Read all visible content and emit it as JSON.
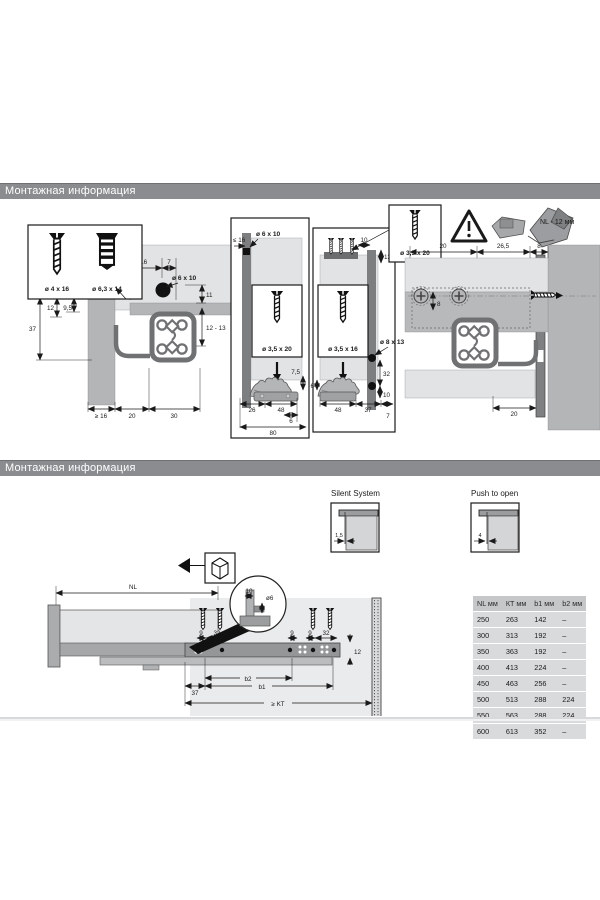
{
  "colors": {
    "header_bar": "#8a8c8f",
    "accent_green": "#2e6b3e",
    "light_gray": "#e2e3e4",
    "mid_gray": "#b3b5b7",
    "profile_gray": "#6f7173"
  },
  "s1": {
    "header": "Монтажная информация",
    "screw_box": {
      "screw1": "ø 4 x 16",
      "screw2": "ø 6,3 x 14"
    },
    "left": {
      "le16": "≤ 16",
      "d7": "7",
      "drill": "ø 6 x 10",
      "d11": "11",
      "d12": "12",
      "d95": "9,5",
      "d37": "37",
      "d1213": "12 - 13",
      "ge16": "≥ 16",
      "d20": "20",
      "d30": "30"
    },
    "p1": {
      "le16": "≤ 16",
      "drill": "ø 6 x 10",
      "screw": "ø 3,5 x 20",
      "d75": "7,5",
      "d26": "26",
      "d48": "48",
      "d6": "6",
      "d80": "80"
    },
    "p2": {
      "d10": "10",
      "d13": "13",
      "screw": "ø 3,5 x 16",
      "drill": "ø 8 x 13",
      "d32": "32",
      "d10b": "10",
      "d6": "6",
      "d48": "48",
      "d37": "37",
      "d7": "7"
    },
    "callout": {
      "screw": "ø 3,5 x 20"
    },
    "note_nl": "NL - 12 мм",
    "right": {
      "d20": "20",
      "d265": "26,5",
      "d8": "8",
      "d8b": "8",
      "d20b": "20"
    }
  },
  "s2": {
    "header": "Монтажная информация",
    "silent": {
      "label": "Silent System",
      "dim": "1,5"
    },
    "push": {
      "label": "Push to open",
      "dim": "4"
    },
    "draw": {
      "nl": "NL",
      "d10": "10",
      "dd6": "ø6",
      "d9a": "9",
      "d32a": "32",
      "d9b": "9",
      "d9c": "9",
      "d32b": "32",
      "d12": "12",
      "d37": "37",
      "b2": "b2",
      "b1": "b1",
      "kt": "≥ KT"
    },
    "table": {
      "headers": [
        "NL мм",
        "КТ мм",
        "b1 мм",
        "b2 мм"
      ],
      "rows": [
        [
          "250",
          "263",
          "142",
          "–"
        ],
        [
          "300",
          "313",
          "192",
          "–"
        ],
        [
          "350",
          "363",
          "192",
          "–"
        ],
        [
          "400",
          "413",
          "224",
          "–"
        ],
        [
          "450",
          "463",
          "256",
          "–"
        ],
        [
          "500",
          "513",
          "288",
          "224"
        ],
        [
          "550",
          "563",
          "288",
          "224"
        ],
        [
          "600",
          "613",
          "352",
          "–"
        ]
      ]
    }
  }
}
